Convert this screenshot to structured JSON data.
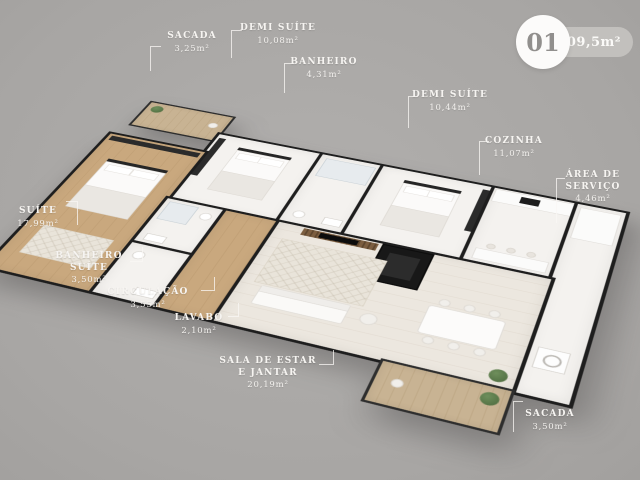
{
  "badge": {
    "number": "01",
    "total_area": "109,5m²"
  },
  "labels": [
    {
      "id": "sacada-top",
      "name": "SACADA",
      "area": "3,25m²"
    },
    {
      "id": "demi-suite-1",
      "name": "DEMI SUÍTE",
      "area": "10,08m²"
    },
    {
      "id": "banheiro",
      "name": "BANHEIRO",
      "area": "4,31m²"
    },
    {
      "id": "demi-suite-2",
      "name": "DEMI SUÍTE",
      "area": "10,44m²"
    },
    {
      "id": "cozinha",
      "name": "COZINHA",
      "area": "11,07m²"
    },
    {
      "id": "area-servico",
      "name": "ÁREA DE SERVIÇO",
      "area": "4,46m²"
    },
    {
      "id": "suite",
      "name": "SUÍTE",
      "area": "17,99m²"
    },
    {
      "id": "banheiro-suite",
      "name": "BANHEIRO SUÍTE",
      "area": "3,50m²"
    },
    {
      "id": "circulacao",
      "name": "CIRCULAÇÃO",
      "area": "3,55m²"
    },
    {
      "id": "lavabo",
      "name": "LAVABO",
      "area": "2,10m²"
    },
    {
      "id": "sala",
      "name": "SALA DE ESTAR E JANTAR",
      "area": "20,19m²"
    },
    {
      "id": "sacada-bottom",
      "name": "SACADA",
      "area": "3,50m²"
    }
  ],
  "colors": {
    "background": "#a8a6a4",
    "wall": "#1e1e1e",
    "floor_white": "#f4f2ef",
    "floor_wood": "#c9a87e",
    "label_text": "#f6f4f1",
    "badge_pill": "#c2c0bd",
    "badge_circle_text": "#91908e",
    "plant_green": "#5e7b4e"
  }
}
